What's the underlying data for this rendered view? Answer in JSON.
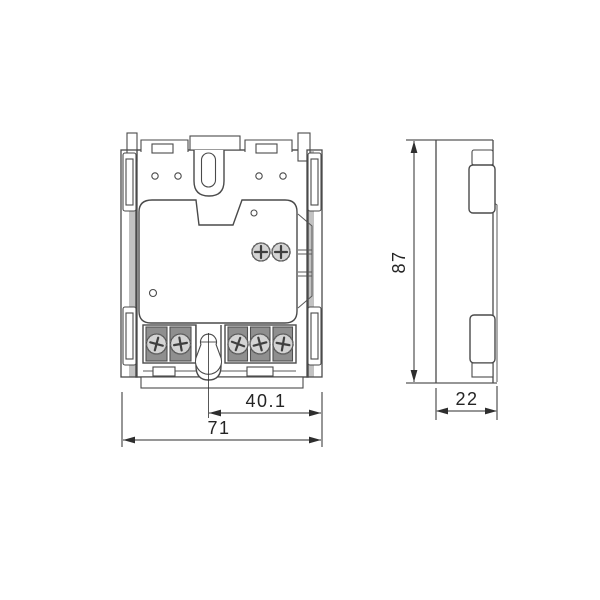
{
  "drawing": {
    "dimensions": {
      "front_total_width": {
        "label": "71"
      },
      "front_keyhole_to_edge": {
        "label": "40.1"
      },
      "side_height": {
        "label": "87"
      },
      "side_depth": {
        "label": "22"
      }
    },
    "structure": {
      "front_view": {
        "top_holes": 4,
        "plate_screws": 2,
        "left_terminal_screws": 2,
        "right_terminal_screws": 3
      },
      "side_view": {
        "terminal_covers": 2
      }
    },
    "colors": {
      "background": "#ffffff",
      "line": "#4a4a4a",
      "dimension": "#2e2e2e",
      "terminal_cell": "#8f8f8f",
      "screw_face": "#d4d4d4",
      "rail_shade": "#c2c2c2"
    }
  }
}
